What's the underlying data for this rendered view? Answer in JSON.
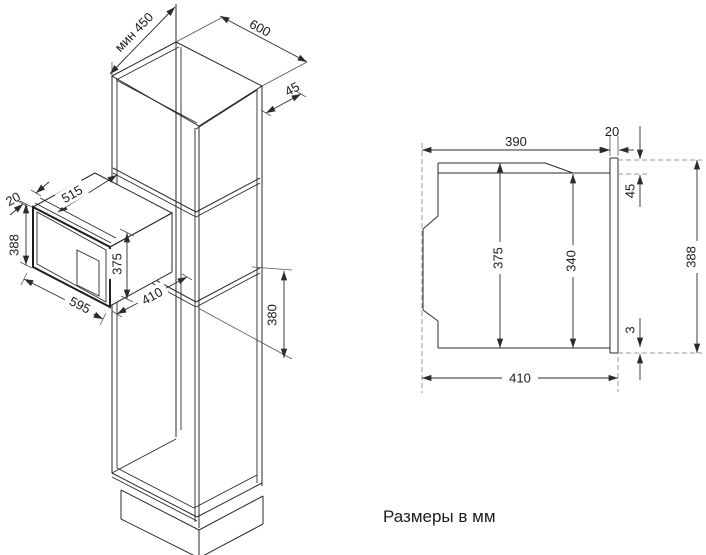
{
  "caption": "Размеры в мм",
  "iso_view": {
    "description": "isometric view of tall cabinet niche with built-in microwave",
    "dims": {
      "niche_min_depth": "мин 450",
      "cabinet_width": "600",
      "front_clearance": "45",
      "top_clearance": "20",
      "door_height": "388",
      "body_depth": "515",
      "body_height": "375",
      "door_width": "595",
      "install_depth": "410",
      "niche_height": "380"
    }
  },
  "side_view": {
    "description": "side section of microwave in niche",
    "dims": {
      "body_depth": "390",
      "frame_thickness": "20",
      "top_overhang": "45",
      "body_height": "375",
      "front_height": "340",
      "frame_height": "388",
      "bottom_gap": "3",
      "total_depth": "410"
    }
  }
}
